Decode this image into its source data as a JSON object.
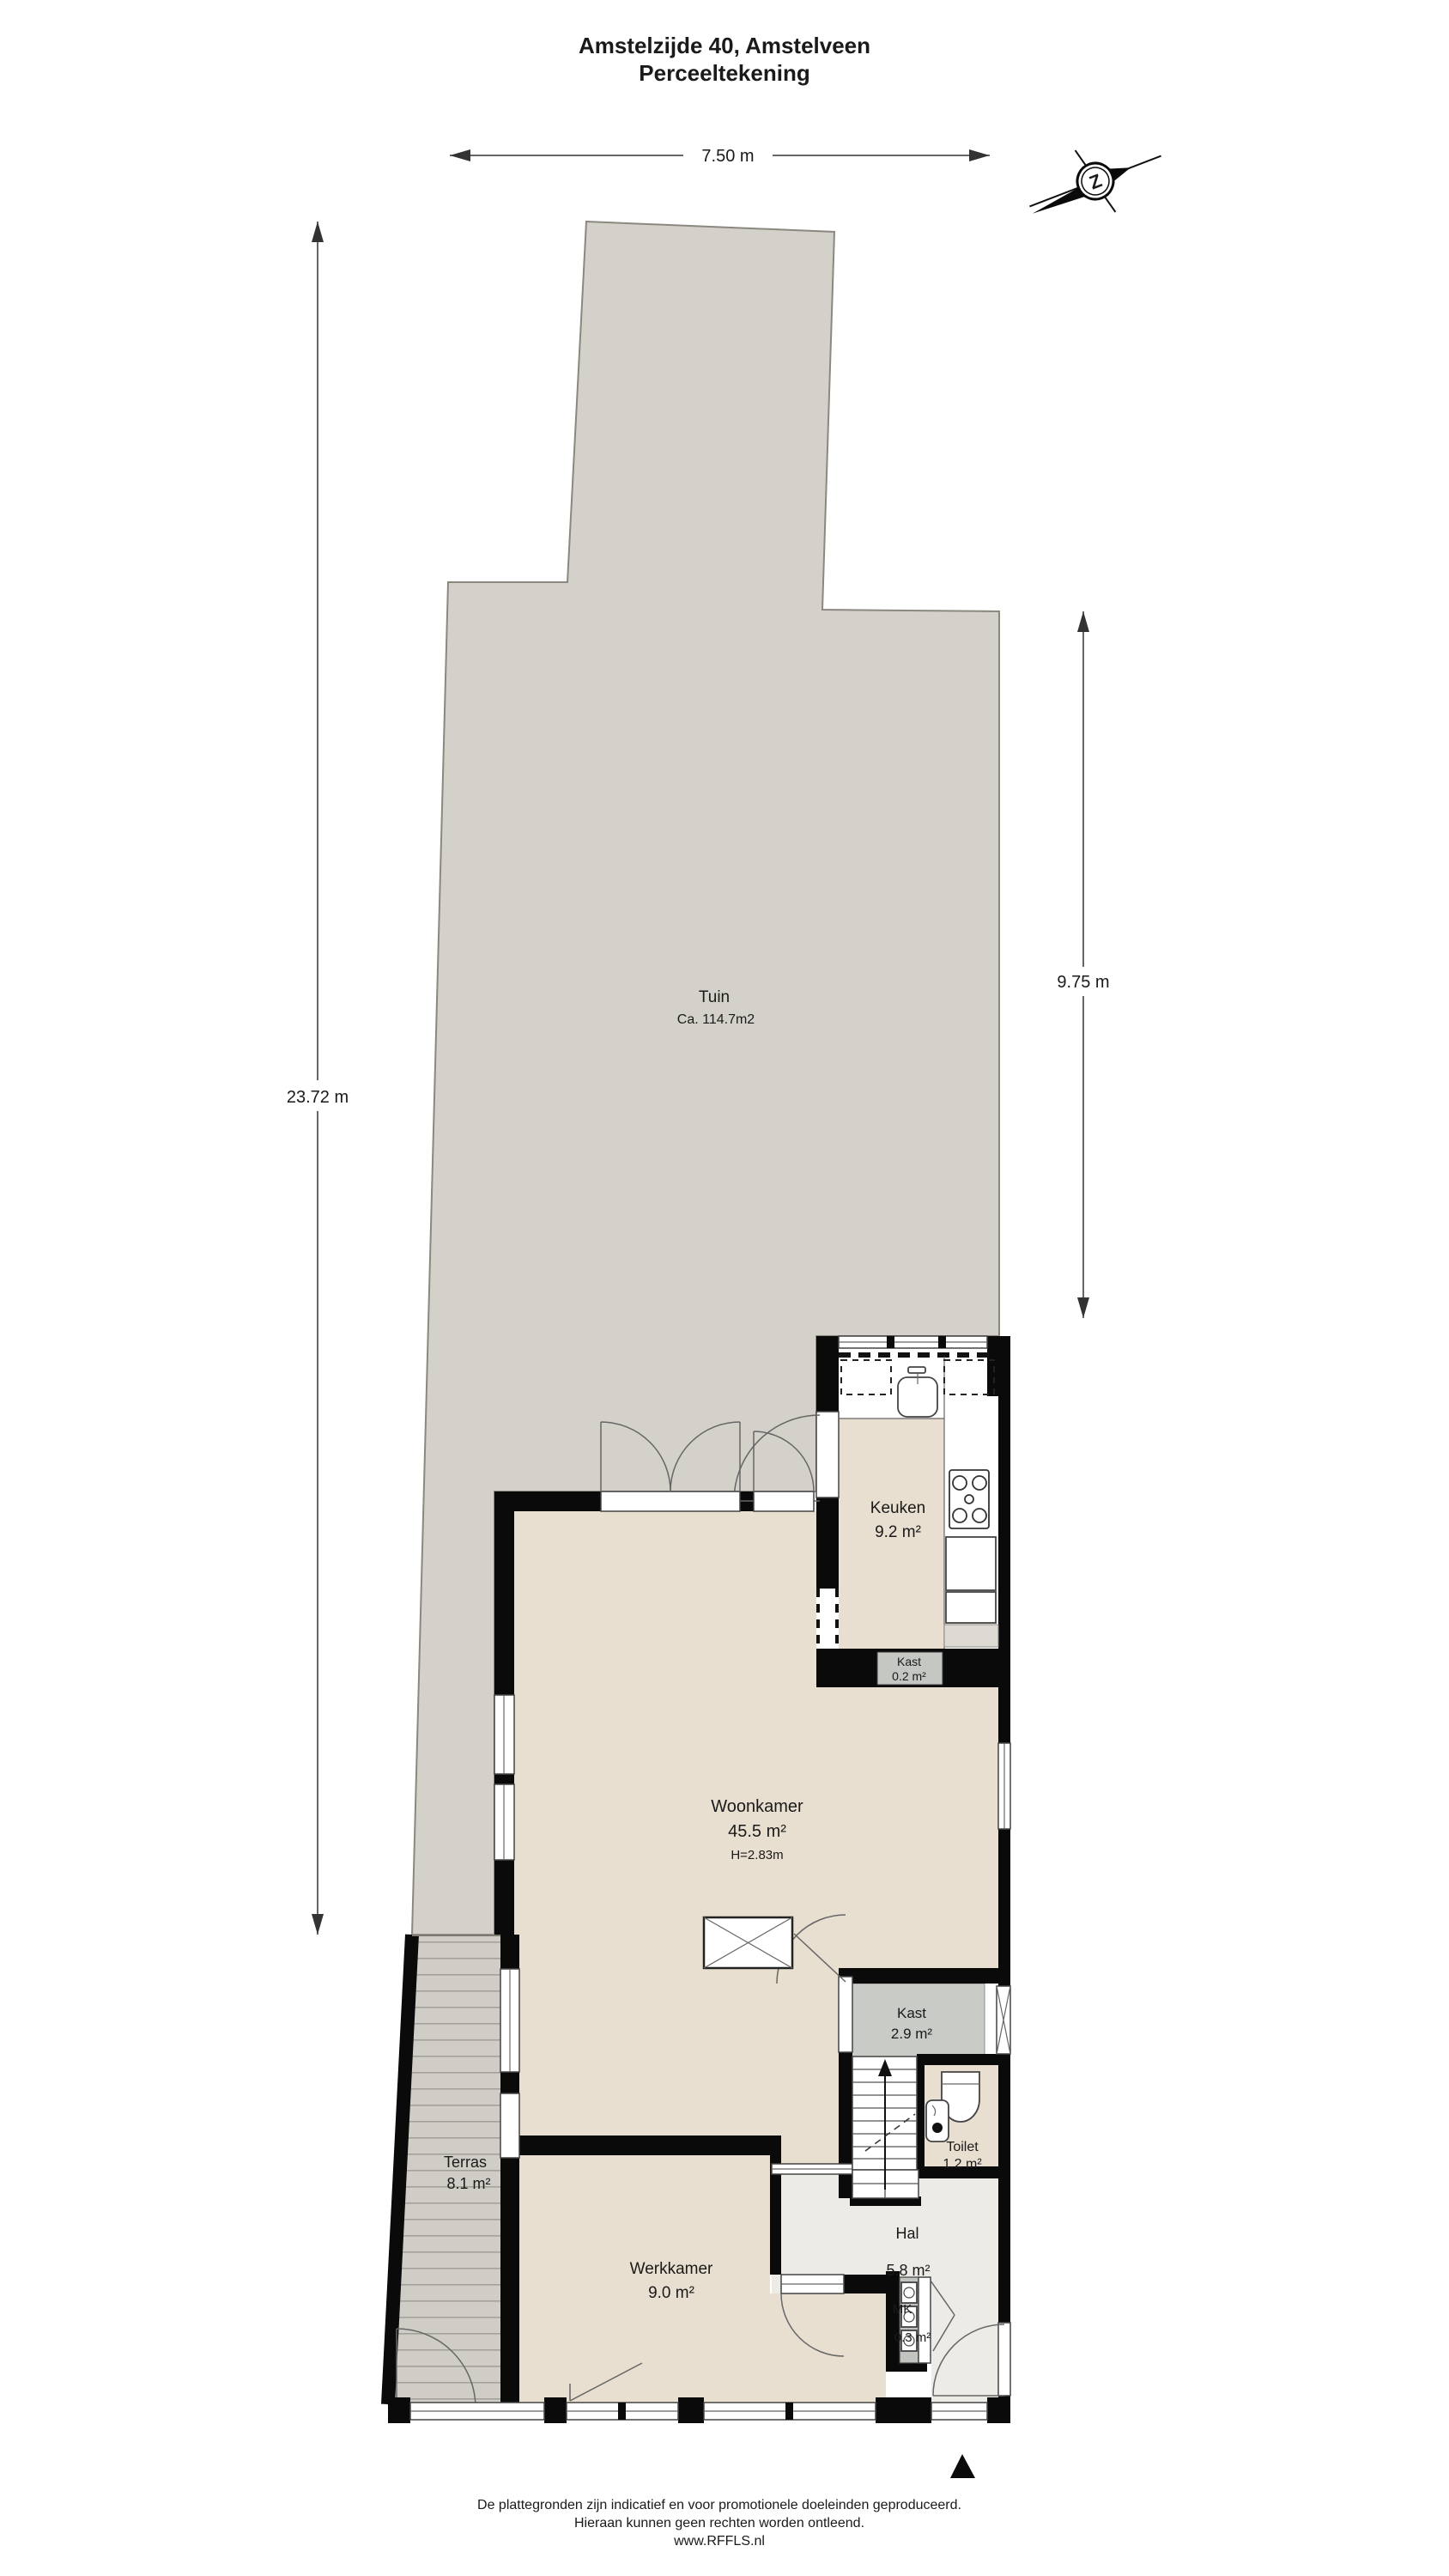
{
  "title": {
    "line1": "Amstelzijde 40, Amstelveen",
    "line2": "Perceeltekening"
  },
  "dimensions": {
    "width_top": "7.50 m",
    "depth_left": "23.72 m",
    "depth_right": "9.75 m"
  },
  "compass": {
    "letter": "Z"
  },
  "garden": {
    "name": "Tuin",
    "area": "Ca. 114.7m2"
  },
  "rooms": {
    "keuken": {
      "name": "Keuken",
      "area": "9.2 m²"
    },
    "kast_klein": {
      "name": "Kast",
      "area": "0.2 m²"
    },
    "woonkamer": {
      "name": "Woonkamer",
      "area": "45.5 m²",
      "height": "H=2.83m"
    },
    "kast": {
      "name": "Kast",
      "area": "2.9 m²"
    },
    "toilet": {
      "name": "Toilet",
      "area": "1.2 m²"
    },
    "hal": {
      "name": "Hal",
      "area": "5.8 m²"
    },
    "werkkamer": {
      "name": "Werkkamer",
      "area": "9.0 m²"
    },
    "terras": {
      "name": "Terras",
      "area": "8.1 m²"
    },
    "meterkast": {
      "name": "MK",
      "area": "0.3 m²"
    }
  },
  "footer": {
    "line1": "De plattegronden zijn indicatief en voor promotionele doeleinden geproduceerd.",
    "line2": "Hieraan kunnen geen rechten worden ontleend.",
    "line3": "www.RFFLS.nl"
  },
  "colors": {
    "garden": "#d3d1c9",
    "floor": "#e8dfd0",
    "hall_floor": "#edebe6",
    "closet_floor": "#c9ccc6",
    "terrace": "#cfcdc6",
    "wall": "#0a0a0a"
  }
}
